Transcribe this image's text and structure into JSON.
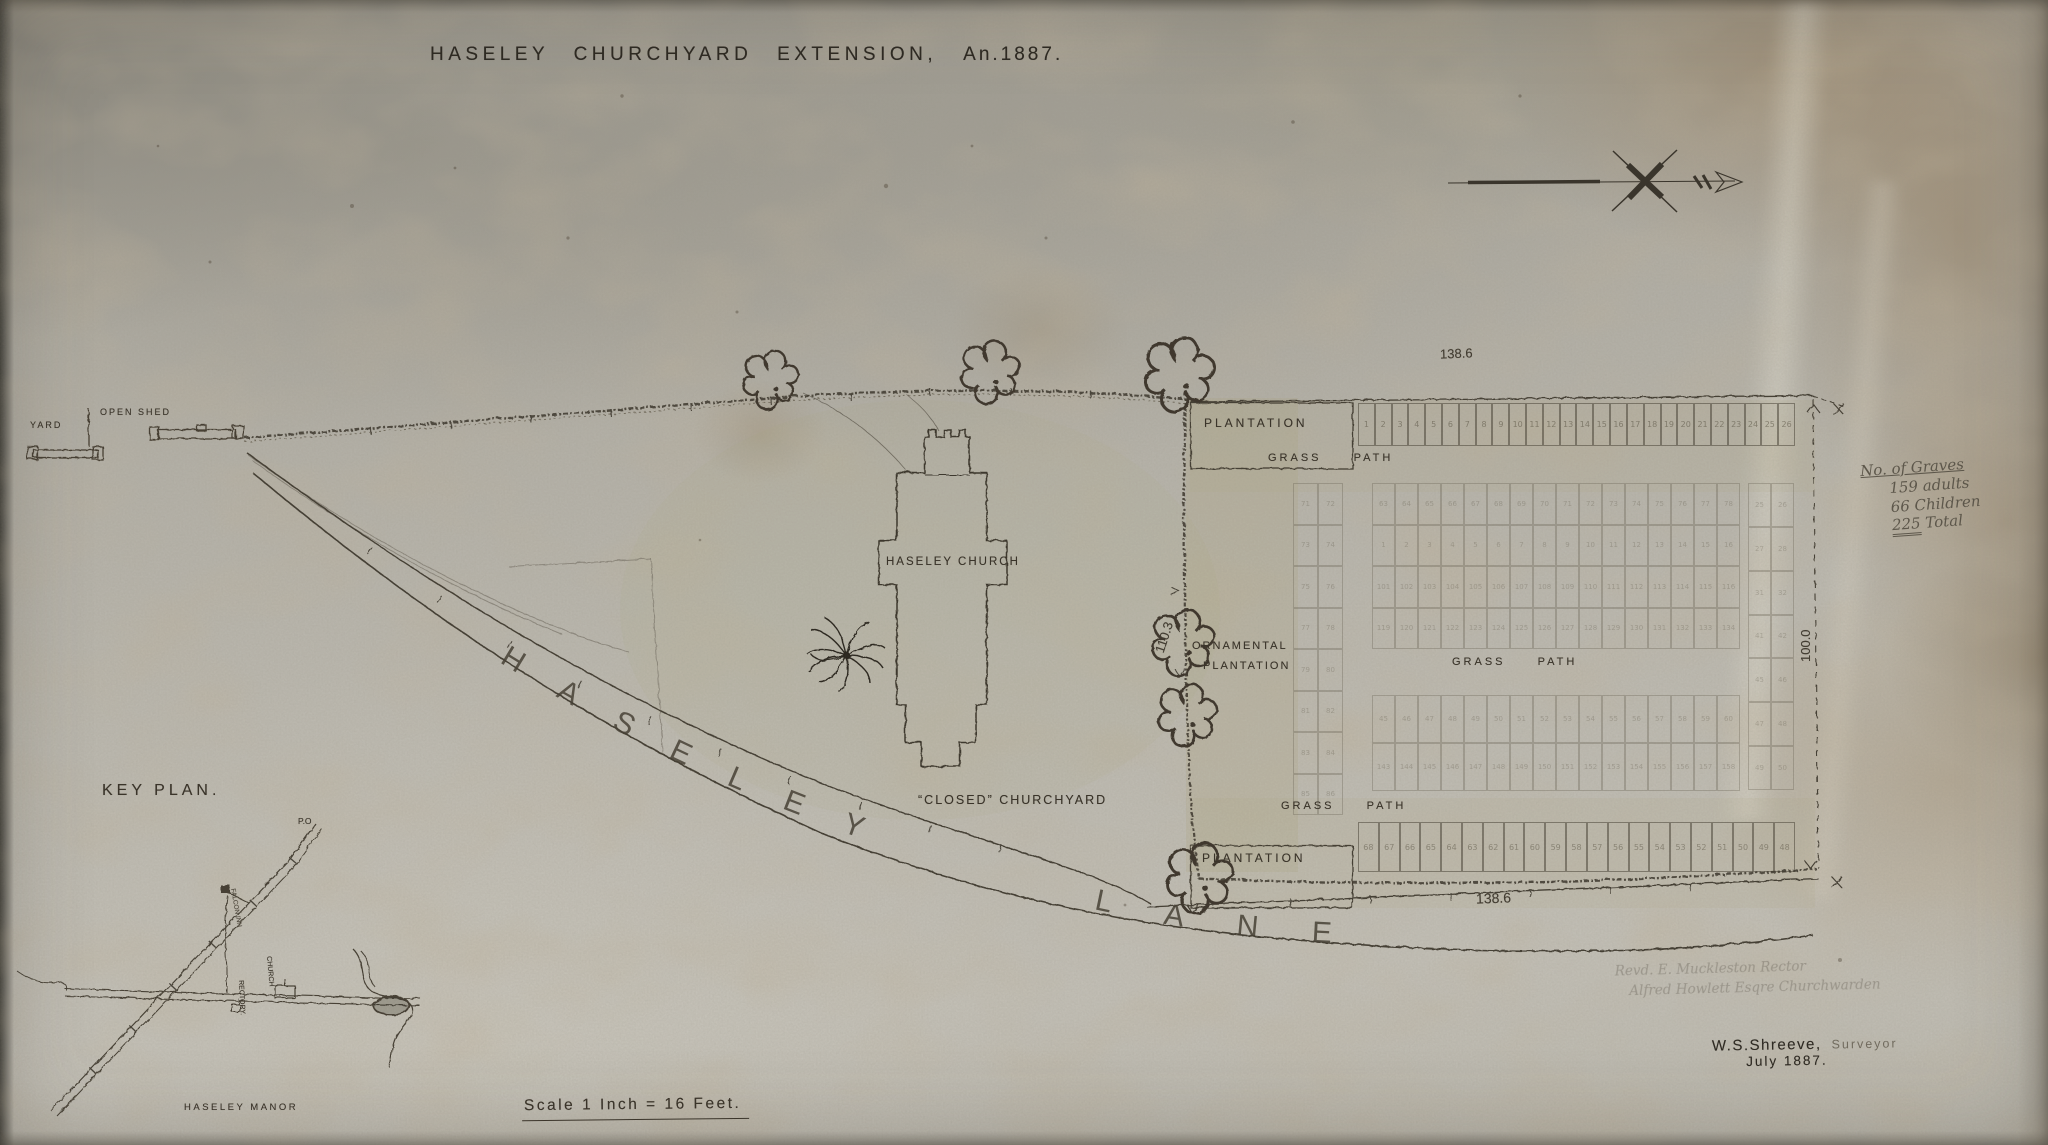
{
  "title": {
    "main": "HASELEY CHURCHYARD EXTENSION,",
    "year": "An.1887."
  },
  "plan_labels": {
    "yard": "YARD",
    "open_shed": "OPEN SHED",
    "plantation_top": "PLANTATION",
    "grass_path_top": "GRASS PATH",
    "ornamental_1": "ORNAMENTAL",
    "ornamental_2": "PLANTATION",
    "haseley_church": "HASELEY CHURCH",
    "closed_churchyard": "“CLOSED” CHURCHYARD",
    "grass_path_mid": "GRASS PATH",
    "grass_path_bottom": "GRASS PATH",
    "plantation_bottom": "PLANTATION",
    "lane_word1": "HASELEY",
    "lane_word2": "LANE"
  },
  "dimensions": {
    "top_width": "138.6",
    "bottom_width": "138.6",
    "right_height": "100.0",
    "ornamental_height": "110.3"
  },
  "grave_notes": {
    "heading": "No. of Graves",
    "adults": "159 adults",
    "children": "66 Children",
    "total_value": "225",
    "total_word": "Total"
  },
  "officials": {
    "line1": "Revd. E. Muckleston    Rector",
    "line2": "Alfred Howlett Esqre   Churchwarden"
  },
  "signature": {
    "name": "W.S.Shreeve,",
    "role": "Surveyor",
    "date": "July  1887."
  },
  "scale_bar": {
    "text": "Scale    1 Inch = 16 Feet."
  },
  "key_plan": {
    "title": "KEY PLAN.",
    "po": "P.O",
    "inn": "FALCON INN",
    "church": "CHURCH",
    "rectory": "RECTORY.",
    "manor": "HASELEY MANOR"
  },
  "plots": {
    "blocks": [
      {
        "name": "top-row",
        "x": 1358,
        "y": 403,
        "w": 437,
        "h": 43,
        "cols": 26,
        "rows": 1,
        "ink": true,
        "numOpacity": 0.5,
        "numbers": [
          "1",
          "2",
          "3",
          "4",
          "5",
          "6",
          "7",
          "8",
          "9",
          "10",
          "11",
          "12",
          "13",
          "14",
          "15",
          "16",
          "17",
          "18",
          "19",
          "20",
          "21",
          "22",
          "23",
          "24",
          "25",
          "26"
        ]
      },
      {
        "name": "left-pairs",
        "x": 1293,
        "y": 483,
        "w": 50,
        "h": 332,
        "cols": 2,
        "rows": 8,
        "ink": false,
        "numOpacity": 0.27,
        "numbers": [
          "71",
          "72",
          "73",
          "74",
          "75",
          "76",
          "77",
          "78",
          "79",
          "80",
          "81",
          "82",
          "83",
          "84",
          "85",
          "86"
        ]
      },
      {
        "name": "upper-block",
        "x": 1372,
        "y": 483,
        "w": 368,
        "h": 166,
        "cols": 16,
        "rows": 4,
        "ink": false,
        "numOpacity": 0.26,
        "numbers": [
          "63",
          "64",
          "65",
          "66",
          "67",
          "68",
          "69",
          "70",
          "71",
          "72",
          "73",
          "74",
          "75",
          "76",
          "77",
          "78",
          "1",
          "2",
          "3",
          "4",
          "5",
          "6",
          "7",
          "8",
          "9",
          "10",
          "11",
          "12",
          "13",
          "14",
          "15",
          "16",
          "101",
          "102",
          "103",
          "104",
          "105",
          "106",
          "107",
          "108",
          "109",
          "110",
          "111",
          "112",
          "113",
          "114",
          "115",
          "116",
          "119",
          "120",
          "121",
          "122",
          "123",
          "124",
          "125",
          "126",
          "127",
          "128",
          "129",
          "130",
          "131",
          "132",
          "133",
          "134"
        ]
      },
      {
        "name": "right-pairs",
        "x": 1748,
        "y": 483,
        "w": 46,
        "h": 307,
        "cols": 2,
        "rows": 7,
        "ink": false,
        "numOpacity": 0.25,
        "numbers": [
          "25",
          "26",
          "27",
          "28",
          "31",
          "32",
          "41",
          "42",
          "45",
          "46",
          "47",
          "48",
          "49",
          "50"
        ]
      },
      {
        "name": "lower-block",
        "x": 1372,
        "y": 695,
        "w": 368,
        "h": 96,
        "cols": 16,
        "rows": 2,
        "ink": false,
        "numOpacity": 0.26,
        "numbers": [
          "45",
          "46",
          "47",
          "48",
          "49",
          "50",
          "51",
          "52",
          "53",
          "54",
          "55",
          "56",
          "57",
          "58",
          "59",
          "60",
          "143",
          "144",
          "145",
          "146",
          "147",
          "148",
          "149",
          "150",
          "151",
          "152",
          "153",
          "154",
          "155",
          "156",
          "157",
          "158"
        ]
      },
      {
        "name": "bottom-row",
        "x": 1358,
        "y": 822,
        "w": 437,
        "h": 50,
        "cols": 21,
        "rows": 1,
        "ink": true,
        "numOpacity": 0.45,
        "numbers": [
          "68",
          "67",
          "66",
          "65",
          "64",
          "63",
          "62",
          "61",
          "60",
          "59",
          "58",
          "57",
          "56",
          "55",
          "54",
          "53",
          "52",
          "51",
          "50",
          "49",
          "48"
        ]
      }
    ]
  }
}
